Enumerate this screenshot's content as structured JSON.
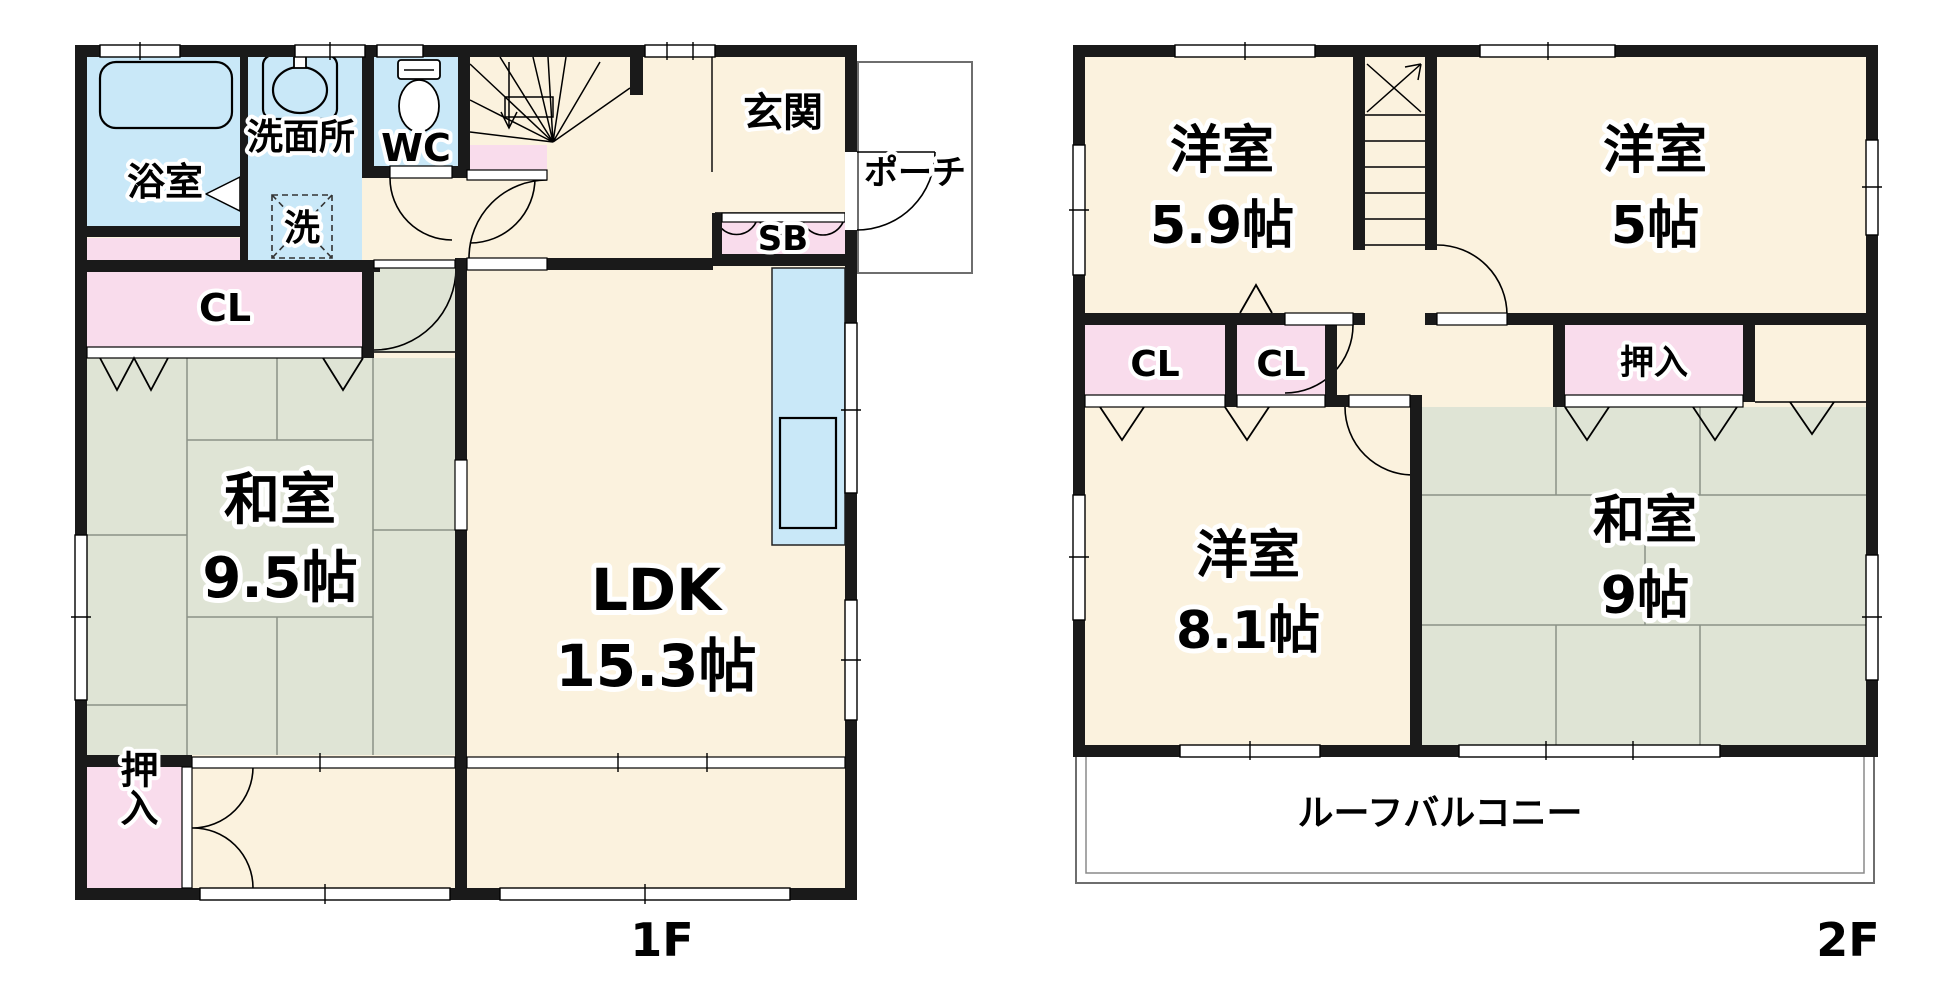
{
  "floor1": {
    "label": "1F",
    "bath": {
      "name": "浴室"
    },
    "washroom": {
      "name": "洗面所",
      "laundry_mark": "洗"
    },
    "wc": {
      "name": "WC"
    },
    "entrance": {
      "name": "玄関"
    },
    "porch": {
      "name": "ポーチ"
    },
    "shoebox": {
      "name": "SB"
    },
    "closet": {
      "name": "CL"
    },
    "washitsu": {
      "name": "和室",
      "size": "9.5帖"
    },
    "ldk": {
      "name": "LDK",
      "size": "15.3帖"
    },
    "oshiire": {
      "name": "押入"
    }
  },
  "floor2": {
    "label": "2F",
    "yoshitsu_a": {
      "name": "洋室",
      "size": "5.9帖"
    },
    "yoshitsu_b": {
      "name": "洋室",
      "size": "5帖"
    },
    "closet_a": {
      "name": "CL"
    },
    "closet_b": {
      "name": "CL"
    },
    "oshiire": {
      "name": "押入"
    },
    "yoshitsu_c": {
      "name": "洋室",
      "size": "8.1帖"
    },
    "washitsu": {
      "name": "和室",
      "size": "9帖"
    },
    "balcony": {
      "name": "ルーフバルコニー"
    }
  },
  "colors": {
    "wall": "#1A1A1A",
    "room_cream": "#FBF2DE",
    "water_blue": "#C9E8F8",
    "closet_pink": "#F9DCEC",
    "tatami_green": "#DFE4D5",
    "outline_gray": "#6E6E6E"
  }
}
